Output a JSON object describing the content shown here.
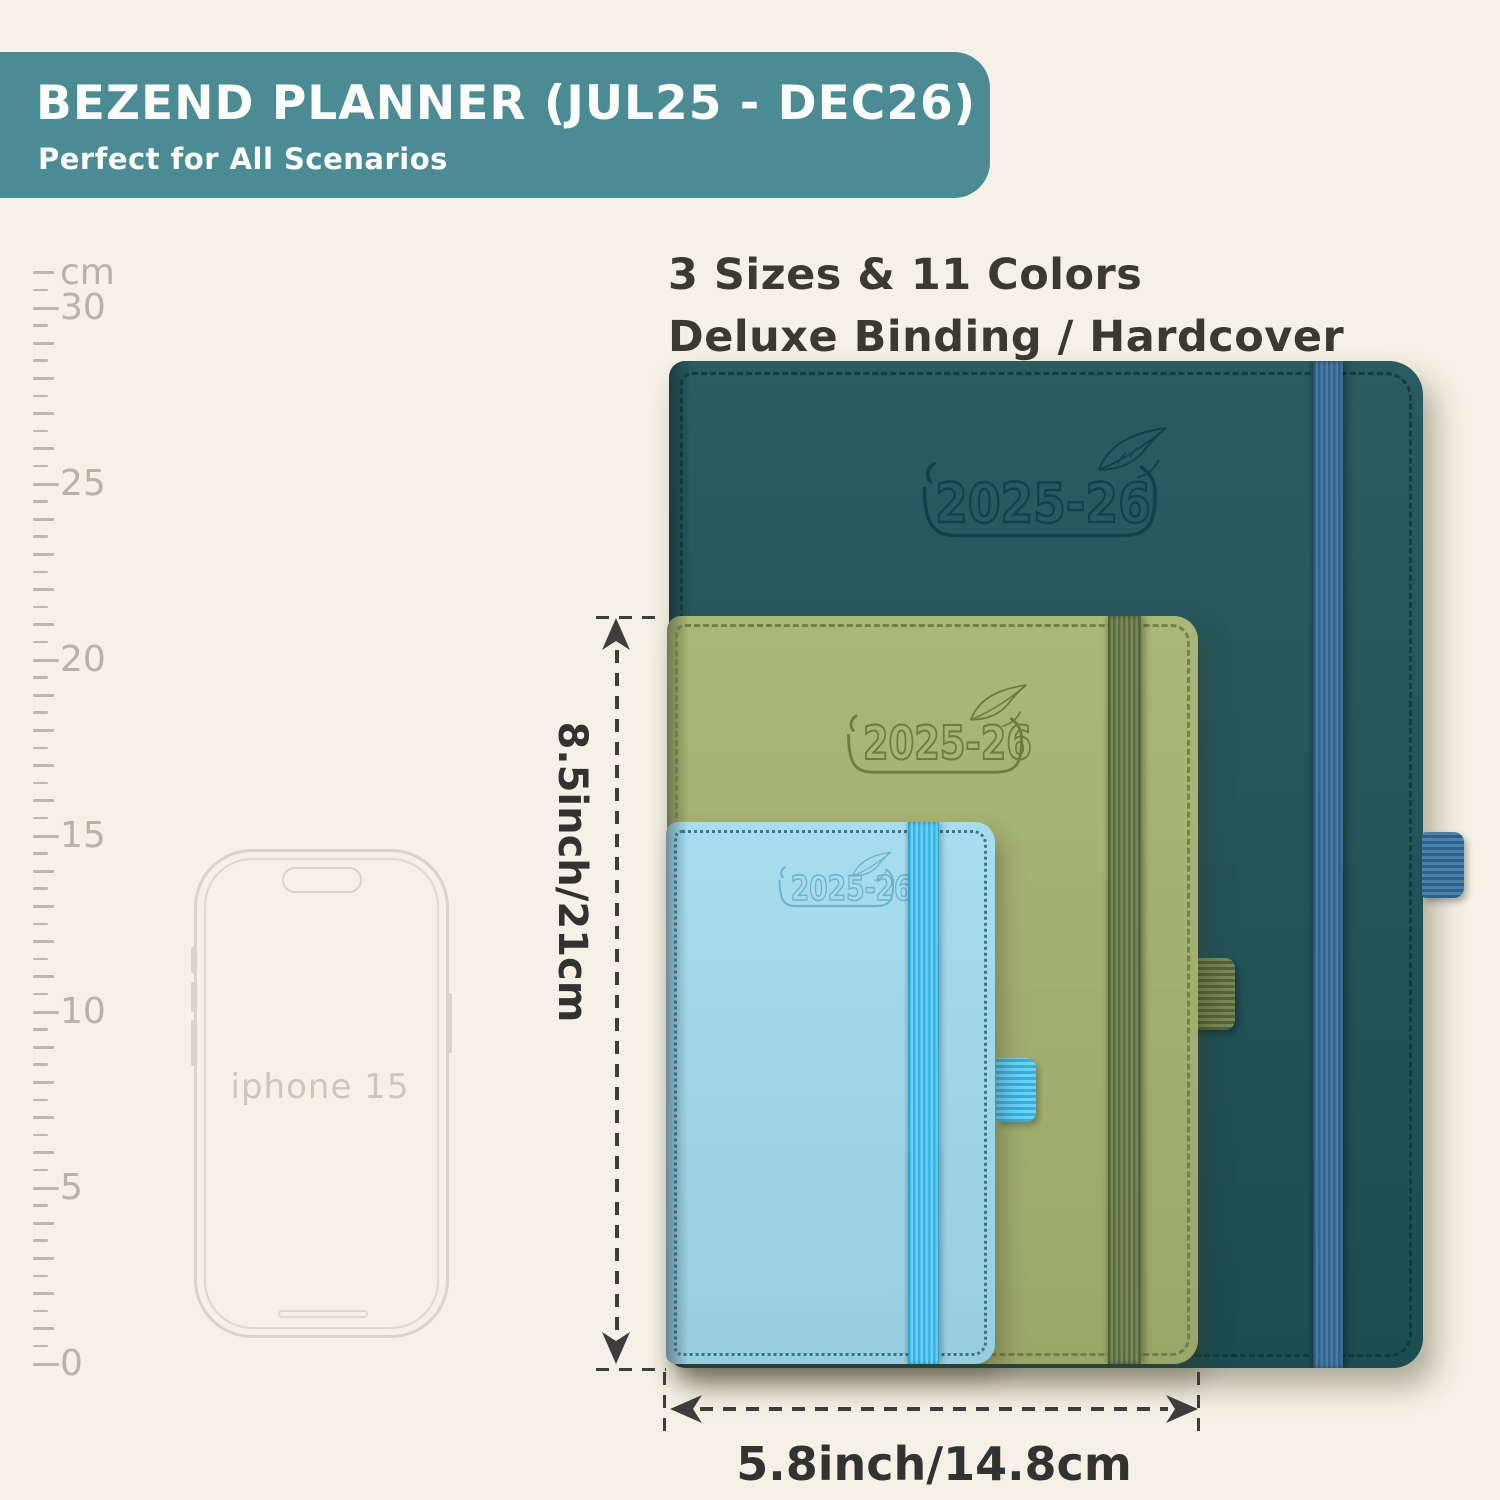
{
  "banner": {
    "title": "BEZEND PLANNER (JUL25 - DEC26)",
    "subtitle": "Perfect for All Scenarios",
    "bg_color": "#4a8b94",
    "text_color": "#fdfdfb"
  },
  "headline": {
    "line1": "3 Sizes & 11 Colors",
    "line2": "Deluxe Binding / Hardcover",
    "color": "#3a3a30"
  },
  "ruler": {
    "unit_label": "cm",
    "major_labels": [
      "0",
      "5",
      "10",
      "15",
      "20",
      "25",
      "30"
    ],
    "cm_min": 0,
    "cm_max": 31,
    "px_per_cm": 35.2,
    "zero_y": 1364,
    "tick_x": 33,
    "label_x": 60,
    "color": "#bcb8ad"
  },
  "phone": {
    "label": "iphone 15",
    "outline_color": "#d8d4c9",
    "label_color": "#cbc7bc"
  },
  "planners": [
    {
      "size_name": "large-letter",
      "year_label": "2025-26",
      "cover_color": "#1e5359",
      "band_color": "#3c73a0",
      "emboss_color": "#11424c",
      "stitch_color": "#10393f"
    },
    {
      "size_name": "medium-a5",
      "year_label": "2025-26",
      "cover_color": "#a7b471",
      "band_color": "#6a7a4b",
      "emboss_color": "#6f7c3c",
      "stitch_color": "#6f7c46"
    },
    {
      "size_name": "small-pocket",
      "year_label": "2025-26",
      "cover_color": "#a4dcf0",
      "band_color": "#53c5ef",
      "emboss_color": "#6cb2cf",
      "stitch_color": "#1d6073"
    }
  ],
  "dimensions": {
    "height_label": "8.5inch/21cm",
    "width_label": "5.8inch/14.8cm",
    "line_color": "#3d3d3d"
  }
}
